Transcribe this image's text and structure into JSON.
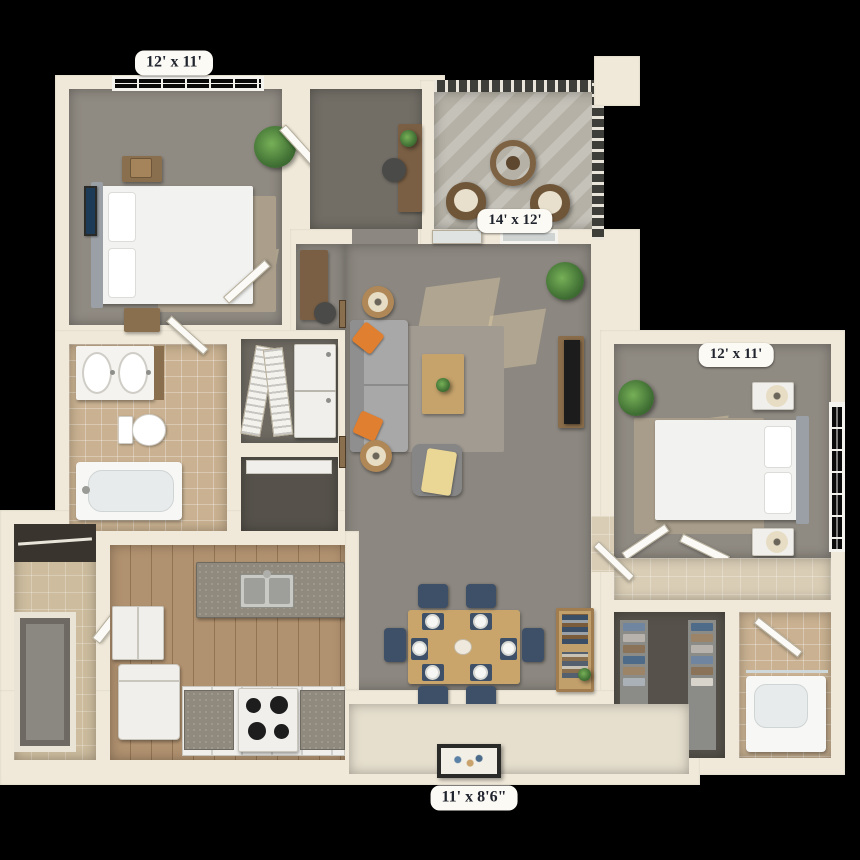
{
  "labels": {
    "bedroom1": "12' x 11'",
    "living_room": "14' x 12'",
    "bedroom2": "12' x 11'",
    "patio": "11' x 8'6\""
  },
  "colors": {
    "background": "#000000",
    "wall": "#f0e9d9",
    "carpet": "#8c8780",
    "den_carpet": "#726e66",
    "wood_floor": "#b19270",
    "bath_tile": "#c9b191",
    "balcony_concrete": "#b5b1a6",
    "counter_granite": "#8f897e",
    "sofa": "#a8a8a8",
    "accent_pillow": "#e07f2f",
    "dining_chair": "#3e5068",
    "table_wood": "#c9a56b",
    "label_bg": "#fcfaf4",
    "label_text": "#20242e"
  }
}
